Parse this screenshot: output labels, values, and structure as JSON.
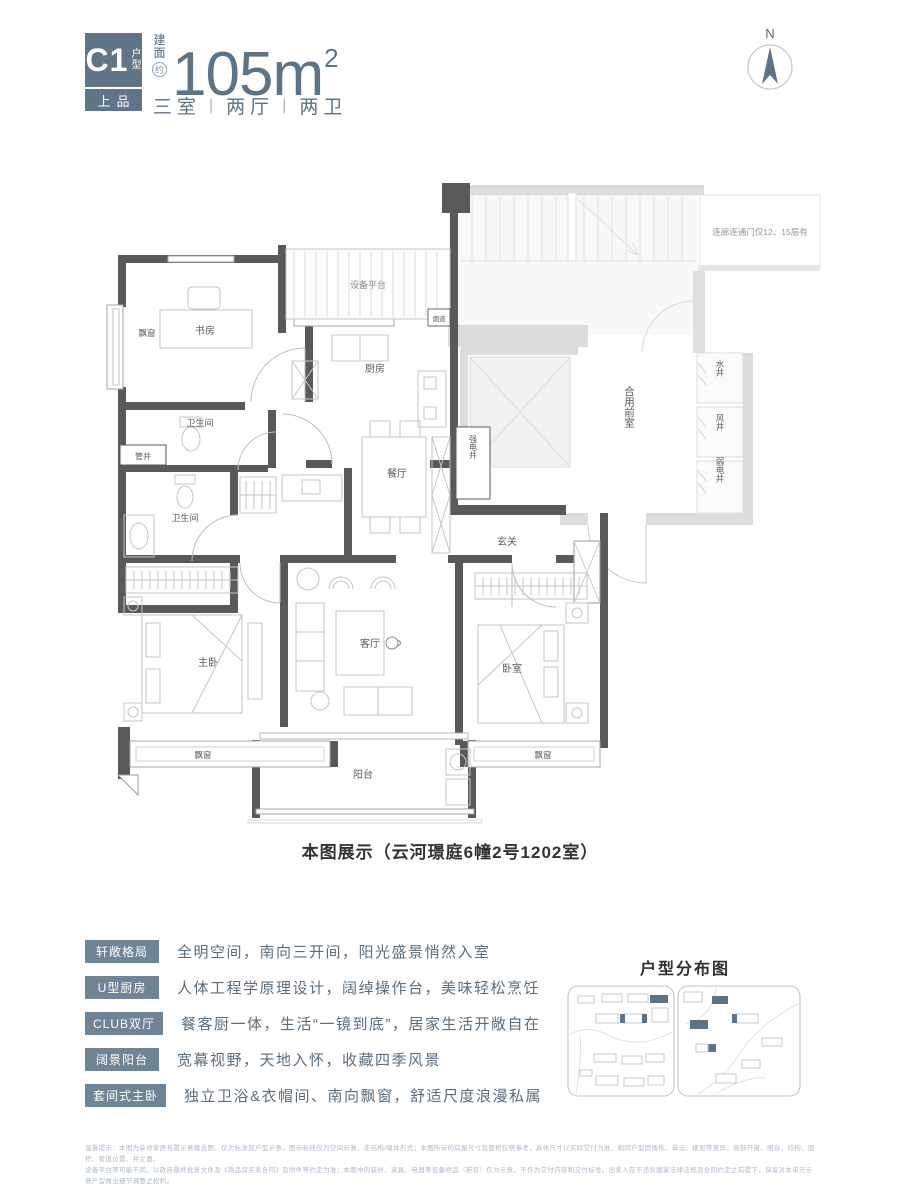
{
  "colors": {
    "accent_slate": "#5d7387",
    "badge": "#617588",
    "tag": "#6f8496",
    "wall_dark": "#59595b",
    "wall_gray": "#dcdcdc"
  },
  "header": {
    "unit_code": "C1",
    "unit_type_chars": [
      "户",
      "型"
    ],
    "badge_bottom": "上品",
    "area_prefix_chars": [
      "建",
      "面"
    ],
    "area_approx": "约",
    "area_value": "105m",
    "area_sup": "2",
    "rooms_summary": [
      "三室",
      "两厅",
      "两卫"
    ],
    "compass_n": "N"
  },
  "plan": {
    "caption": "本图展示（云河璟庭6幢2号1202室）",
    "rooms": {
      "study": "书房",
      "bay_window_left": "飘窗",
      "equipment_platform": "设备平台",
      "flue": "烟道",
      "kitchen": "厨房",
      "bath1": "卫生间",
      "pipe_shaft": "管井",
      "bath2": "卫生间",
      "dining": "餐厅",
      "strong_elec_shaft": "强电井",
      "foyer": "玄关",
      "shared_front_room": "合用前室",
      "water_shaft": "水井",
      "wind_shaft": "风井",
      "weak_elec_shaft": "弱电井",
      "corridor_note": "连廊连通门仅12、15层有",
      "master": "主卧",
      "living": "客厅",
      "bedroom2": "卧室",
      "bay_window_bottom_left": "飘窗",
      "bay_window_bottom_right": "飘窗",
      "balcony": "阳台"
    }
  },
  "features": [
    {
      "tag": "轩敞格局",
      "desc": "全明空间，南向三开间，阳光盛景悄然入室"
    },
    {
      "tag": "U型厨房",
      "desc": "人体工程学原理设计，阔绰操作台，美味轻松烹饪"
    },
    {
      "tag": "CLUB双厅",
      "desc": "餐客厨一体，生活“一镜到底”，居家生活开敞自在"
    },
    {
      "tag": "阔景阳台",
      "desc": "宽幕视野，天地入怀，收藏四季风景"
    },
    {
      "tag": "套间式主卧",
      "desc": "独立卫浴&衣帽间、南向飘窗，舒适尺度浪漫私属"
    }
  ],
  "sitemap": {
    "title": "户型分布图"
  },
  "footer": {
    "line1": "温馨提示：本图为装修家居布置示意概念图，仅为标准层户型示意，图示标线仅为空间示意，非结构/墙体形式；本图所示的房屋尺寸及面积仅供参考，具体尺寸以实际交付为准，相同户型因楼栋、单元、楼层等差异，局部开窗、阳台、结构、面积、管道位置、井立面、",
    "line2": "设备平台等可能不同，以政府最终批复文件及《商品房买卖合同》及附件等约定为准；本图中的装修、家具、电器等设备物品（若有）仅为示意，不作为交付内容和交付标准。出卖人在不违反国家法律法规及合同约定之前提下，保留对本单元示意户型做出细节调整之权利。"
  }
}
